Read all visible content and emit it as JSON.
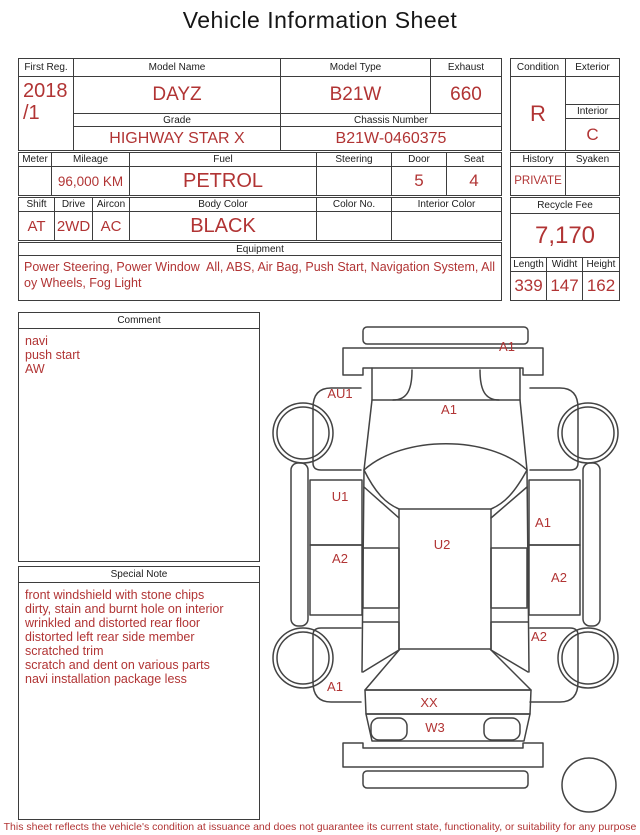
{
  "title": "Vehicle Information Sheet",
  "colors": {
    "accent_red": "#b13434",
    "border": "#3d3d3d",
    "background": "#ffffff"
  },
  "table": {
    "first_reg": {
      "label": "First Reg.",
      "value": "2018\n/1"
    },
    "model_name": {
      "label": "Model Name",
      "value": "DAYZ"
    },
    "model_type": {
      "label": "Model Type",
      "value": "B21W"
    },
    "exhaust": {
      "label": "Exhaust",
      "value": "660"
    },
    "grade": {
      "label": "Grade",
      "value": "HIGHWAY STAR X"
    },
    "chassis": {
      "label": "Chassis Number",
      "value": "B21W-0460375"
    },
    "meter": {
      "label": "Meter",
      "value": ""
    },
    "mileage": {
      "label": "Mileage",
      "value": "96,000 KM"
    },
    "fuel": {
      "label": "Fuel",
      "value": "PETROL"
    },
    "steering": {
      "label": "Steering",
      "value": ""
    },
    "door": {
      "label": "Door",
      "value": "5"
    },
    "seat": {
      "label": "Seat",
      "value": "4"
    },
    "shift": {
      "label": "Shift",
      "value": "AT"
    },
    "drive": {
      "label": "Drive",
      "value": "2WD"
    },
    "aircon": {
      "label": "Aircon",
      "value": "AC"
    },
    "body_color": {
      "label": "Body Color",
      "value": "BLACK"
    },
    "color_no": {
      "label": "Color No.",
      "value": ""
    },
    "interior_color": {
      "label": "Interior Color",
      "value": ""
    },
    "equipment": {
      "label": "Equipment",
      "value": "Power Steering, Power Window  All, ABS, Air Bag, Push Start, Navigation System, Alloy Wheels, Fog Light"
    }
  },
  "side_panel": {
    "condition": {
      "label": "Condition",
      "value": "R"
    },
    "exterior": {
      "label": "Exterior",
      "value": ""
    },
    "interior": {
      "label": "Interior",
      "value": "C"
    },
    "history": {
      "label": "History",
      "value": "PRIVATE"
    },
    "syaken": {
      "label": "Syaken",
      "value": ""
    },
    "recycle_fee": {
      "label": "Recycle Fee",
      "value": "7,170"
    },
    "length": {
      "label": "Length",
      "value": "339"
    },
    "widht": {
      "label": "Widht",
      "value": "147"
    },
    "height": {
      "label": "Height",
      "value": "162"
    }
  },
  "comment": {
    "label": "Comment",
    "lines": [
      "navi",
      "push start",
      "AW"
    ]
  },
  "special_note": {
    "label": "Special Note",
    "lines": [
      "front windshield with stone chips",
      "dirty, stain and burnt hole on interior",
      "wrinkled and distorted rear floor",
      "distorted left rear side member",
      "scratched trim",
      "scratch and dent on various parts",
      "navi installation package less"
    ]
  },
  "diagram": {
    "labels": [
      {
        "code": "A1"
      },
      {
        "code": "AU1"
      },
      {
        "code": "A1"
      },
      {
        "code": "U1"
      },
      {
        "code": "A1"
      },
      {
        "code": "A2"
      },
      {
        "code": "U2"
      },
      {
        "code": "A2"
      },
      {
        "code": "A2"
      },
      {
        "code": "A1"
      },
      {
        "code": "XX"
      },
      {
        "code": "W3"
      }
    ]
  },
  "footer": "This sheet reflects the vehicle's condition at issuance and does not guarantee its current state, functionality, or suitability for any purpose"
}
